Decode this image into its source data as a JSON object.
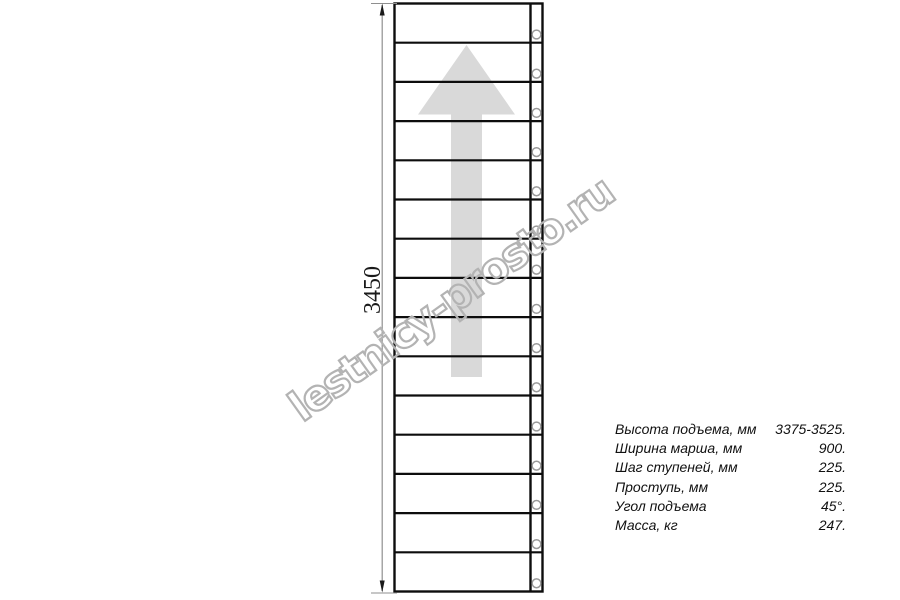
{
  "drawing": {
    "dimension_label": "3450",
    "stairs": {
      "step_count": 15,
      "screw_hole_count": 15
    }
  },
  "specs": {
    "rows": [
      {
        "label": "Высота подъема, мм",
        "value": "3375-3525."
      },
      {
        "label": "Ширина марша, мм",
        "value": "900."
      },
      {
        "label": "Шаг ступеней, мм",
        "value": "225."
      },
      {
        "label": "Проступь, мм",
        "value": "225."
      },
      {
        "label": "Угол подъема",
        "value": "45°."
      },
      {
        "label": "Масса, кг",
        "value": "247."
      }
    ]
  },
  "watermark": {
    "text": "lestnicy-prosto.ru"
  },
  "colors": {
    "line": "#000000",
    "direction_arrow": "#d9d9d9",
    "dimension_line": "#8f8f8f",
    "watermark_outline": "#b3b3b3"
  }
}
